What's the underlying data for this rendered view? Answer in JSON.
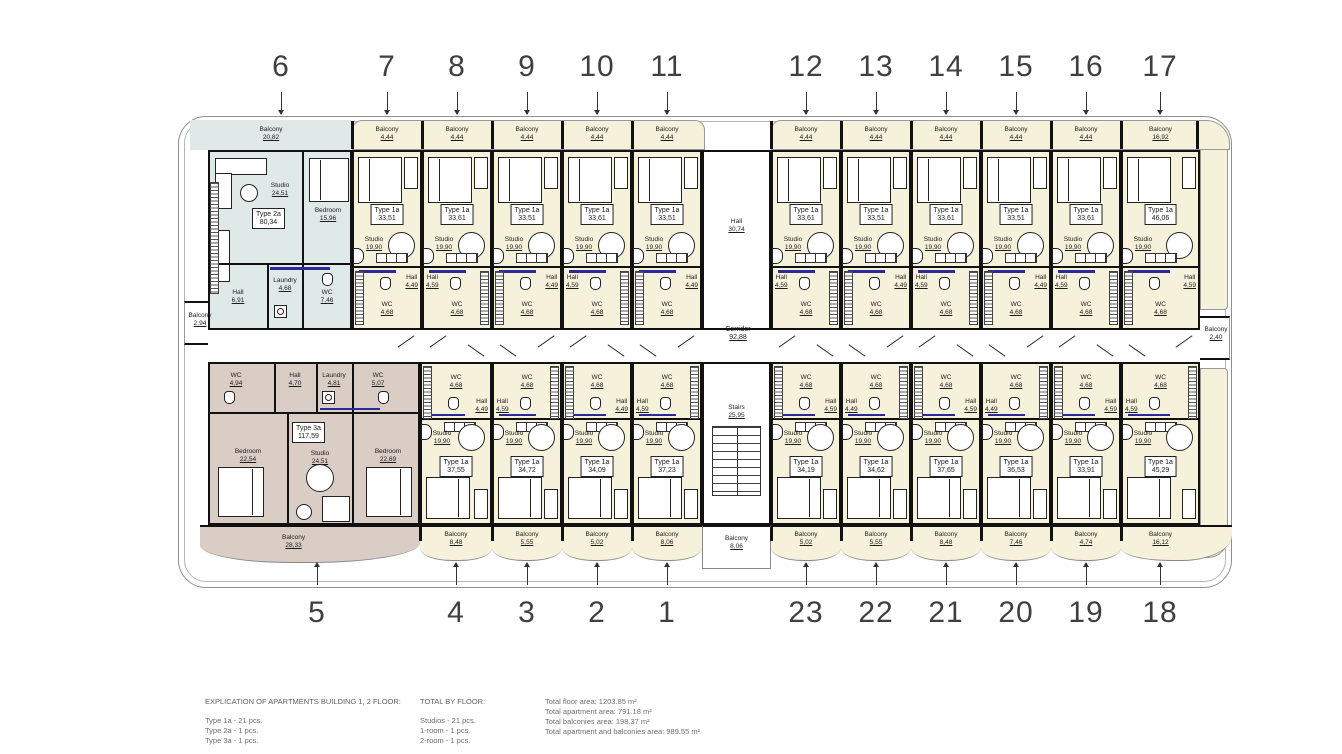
{
  "labels": {
    "balcony": "Balcony",
    "studio": "Studio",
    "hall": "Hall",
    "wc": "WC",
    "laundry": "Laundry",
    "bedroom": "Bedroom",
    "corridor": "Corridor",
    "stairs": "Stairs"
  },
  "axis_top": [
    "6",
    "7",
    "8",
    "9",
    "10",
    "11",
    "12",
    "13",
    "14",
    "15",
    "16",
    "17"
  ],
  "axis_bottom": [
    "5",
    "4",
    "3",
    "2",
    "1",
    "23",
    "22",
    "21",
    "20",
    "19",
    "18"
  ],
  "unit6": {
    "number": "6",
    "type": "Type 2a",
    "area": "80,34",
    "balcony": "20,82",
    "studio": "24,51",
    "bedroom": "15,96",
    "hall": "6,91",
    "laundry": "4,68",
    "wc": "7,46"
  },
  "unit5": {
    "number": "5",
    "type": "Type 3a",
    "area": "117,59",
    "balcony": "28,33",
    "wc1": "4,94",
    "hall": "4,70",
    "laundry": "4,81",
    "wc2": "5,07",
    "bedroom1": "22,54",
    "studio": "24,51",
    "bedroom2": "22,69"
  },
  "top_units": [
    {
      "number": "7",
      "type": "Type 1a",
      "area": "33,51",
      "studio": "19,90",
      "hall": "4,49",
      "wc": "4,68",
      "balcony": "4,44"
    },
    {
      "number": "8",
      "type": "Type 1a",
      "area": "33,61",
      "studio": "19,90",
      "hall": "4,59",
      "wc": "4,68",
      "balcony": "4,44"
    },
    {
      "number": "9",
      "type": "Type 1a",
      "area": "33,51",
      "studio": "19,90",
      "hall": "4,49",
      "wc": "4,68",
      "balcony": "4,44"
    },
    {
      "number": "10",
      "type": "Type 1a",
      "area": "33,61",
      "studio": "19,90",
      "hall": "4,59",
      "wc": "4,68",
      "balcony": "4,44"
    },
    {
      "number": "11",
      "type": "Type 1a",
      "area": "33,51",
      "studio": "19,90",
      "hall": "4,49",
      "wc": "4,68",
      "balcony": "4,44"
    },
    {
      "number": "12",
      "type": "Type 1a",
      "area": "33,61",
      "studio": "19,90",
      "hall": "4,59",
      "wc": "4,68",
      "balcony": "4,44"
    },
    {
      "number": "13",
      "type": "Type 1a",
      "area": "33,51",
      "studio": "19,90",
      "hall": "4,49",
      "wc": "4,68",
      "balcony": "4,44"
    },
    {
      "number": "14",
      "type": "Type 1a",
      "area": "33,61",
      "studio": "19,90",
      "hall": "4,59",
      "wc": "4,68",
      "balcony": "4,44"
    },
    {
      "number": "15",
      "type": "Type 1a",
      "area": "33,51",
      "studio": "19,90",
      "hall": "4,49",
      "wc": "4,68",
      "balcony": "4,44"
    },
    {
      "number": "16",
      "type": "Type 1a",
      "area": "33,61",
      "studio": "19,90",
      "hall": "4,59",
      "wc": "4,68",
      "balcony": "4,44"
    },
    {
      "number": "17",
      "type": "Type 1a",
      "area": "46,06",
      "studio": "19,90",
      "hall": "4,59",
      "wc": "4,68",
      "balcony": "16,92"
    }
  ],
  "bottom_units": [
    {
      "number": "4",
      "type": "Type 1a",
      "area": "37,55",
      "studio": "19,90",
      "hall": "4,49",
      "wc": "4,68",
      "balcony": "8,48"
    },
    {
      "number": "3",
      "type": "Type 1a",
      "area": "34,72",
      "studio": "19,90",
      "hall": "4,59",
      "wc": "4,68",
      "balcony": "5,55"
    },
    {
      "number": "2",
      "type": "Type 1a",
      "area": "34,09",
      "studio": "19,90",
      "hall": "4,49",
      "wc": "4,68",
      "balcony": "5,02"
    },
    {
      "number": "1",
      "type": "Type 1a",
      "area": "37,23",
      "studio": "19,90",
      "hall": "4,59",
      "wc": "4,68",
      "balcony": "8,06"
    },
    {
      "number": "23",
      "type": "Type 1a",
      "area": "34,19",
      "studio": "19,90",
      "hall": "4,59",
      "wc": "4,68",
      "balcony": "5,02"
    },
    {
      "number": "22",
      "type": "Type 1a",
      "area": "34,62",
      "studio": "19,90",
      "hall": "4,49",
      "wc": "4,68",
      "balcony": "5,55"
    },
    {
      "number": "21",
      "type": "Type 1a",
      "area": "37,65",
      "studio": "19,90",
      "hall": "4,59",
      "wc": "4,68",
      "balcony": "8,48"
    },
    {
      "number": "20",
      "type": "Type 1a",
      "area": "36,53",
      "studio": "19,90",
      "hall": "4,49",
      "wc": "4,68",
      "balcony": "7,46"
    },
    {
      "number": "19",
      "type": "Type 1a",
      "area": "33,91",
      "studio": "19,90",
      "hall": "4,59",
      "wc": "4,68",
      "balcony": "4,74"
    },
    {
      "number": "18",
      "type": "Type 1a",
      "area": "45,29",
      "studio": "19,90",
      "hall": "4,59",
      "wc": "4,68",
      "balcony": "16,12"
    }
  ],
  "common": {
    "hall_top": {
      "label": "Hall",
      "area": "30,74"
    },
    "corridor": {
      "label": "Corridor",
      "area": "92,88"
    },
    "stairs": {
      "label": "Stairs",
      "area": "25,95"
    },
    "stairs_balcony": {
      "label": "Balcony",
      "area": "8,06"
    },
    "balcony_left": {
      "label": "Balcony",
      "area": "2,94"
    },
    "balcony_right": {
      "label": "Balcony",
      "area": "2,40"
    }
  },
  "legend": {
    "explication_title": "EXPLICATION OF APARTMENTS BUILDING 1, 2 FLOOR:",
    "explication_rows": [
      "Type 1a - 21 pcs.",
      "Type 2a - 1 pcs.",
      "Type 3a - 1 pcs."
    ],
    "total_title": "TOTAL BY FLOOR:",
    "total_rows": [
      "Studios - 21 pcs.",
      "1-room - 1 pcs.",
      "2-room - 1 pcs."
    ],
    "total_sum": "Total - 23 pcs.",
    "areas_rows": [
      "Total floor area: 1203.85 m²",
      "Total apartment area: 791.18 m²",
      "Total balconies area: 198.37 m²",
      "Total apartment and balconies area: 989.55 m²"
    ]
  },
  "colors": {
    "type1a_fill": "#f6f1da",
    "type2a_fill": "#dfe9e8",
    "type3a_fill": "#d9cdc6",
    "wall": "#111111",
    "bath_accent": "#2a2a99",
    "outline": "#8e8e8e"
  }
}
